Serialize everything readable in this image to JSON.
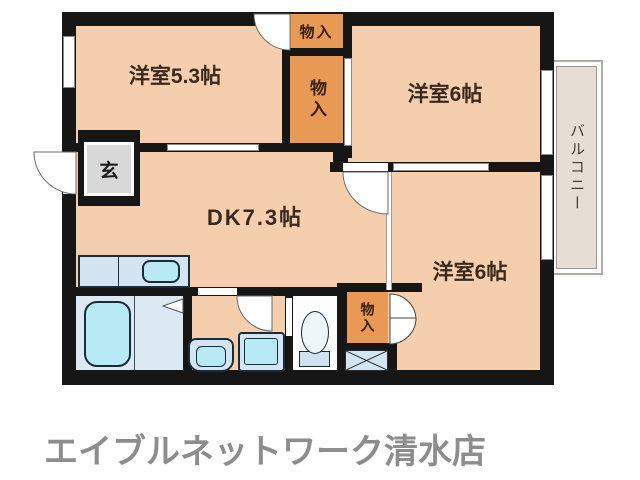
{
  "plan": {
    "rooms": {
      "room_5_3": "洋室5.3帖",
      "room_6_top": "洋室6帖",
      "dk": "DK7.3帖",
      "room_6_bottom": "洋室6帖",
      "genkan": "玄",
      "balcony": "バルコニー"
    },
    "closets": {
      "top": "物入",
      "middle": "物入",
      "bottom": "物入"
    }
  },
  "footer": {
    "store_name": "エイブルネットワーク清水店"
  },
  "colors": {
    "room_fill": "#f5cfad",
    "closet_fill": "#e89a54",
    "wall": "#161616",
    "genkan_fill": "#d8d8d8",
    "balcony_fill": "#e6ded5",
    "fixture_blue": "#d3e4f2",
    "fixture_cyan": "#b7eaf4",
    "label_text": "#3a2a1e",
    "footer_text": "#8d8d8d"
  }
}
